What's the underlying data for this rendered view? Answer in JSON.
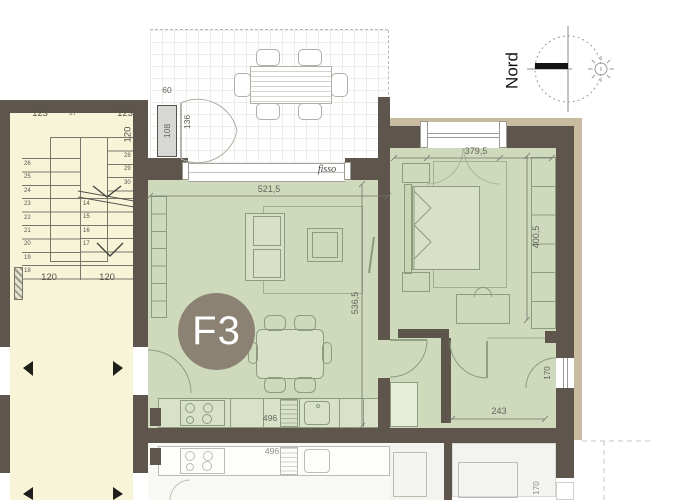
{
  "compass": {
    "north_label": "Nord"
  },
  "unit_label": "F3",
  "dimensions": {
    "terrace_niche": "60",
    "terrace_cabinet": "108",
    "terrace_door": "136",
    "window_fixed_label": "fisso",
    "living_width": "521,5",
    "living_depth": "536,5",
    "kitchen_length": "496",
    "bedroom_width": "379,5",
    "bedroom_depth": "400,5",
    "hall_width": "243",
    "hall_window": "170"
  },
  "stairwell": {
    "width_top_left": "123",
    "step_mid": "27",
    "width_top_right": "123",
    "depth_right": "120",
    "width_bottom_left": "120",
    "width_bottom_right": "120",
    "left_flight_steps": [
      "26",
      "25",
      "24",
      "23",
      "22",
      "21",
      "20",
      "19",
      "18"
    ],
    "right_flight_steps": [
      "14",
      "15",
      "16",
      "17"
    ],
    "upper_flight_steps": [
      "28",
      "29",
      "30"
    ]
  },
  "lower_unit": {
    "kitchen_length": "496",
    "window": "170"
  },
  "colors": {
    "wall": "#5e564c",
    "wall_outer_band": "#c8bba0",
    "apartment_fill": "#cfdabc",
    "stairwell_fill": "#f8f4d8",
    "unit_badge": "#8b8274",
    "lower_floor_fill": "#f3f3f0"
  }
}
